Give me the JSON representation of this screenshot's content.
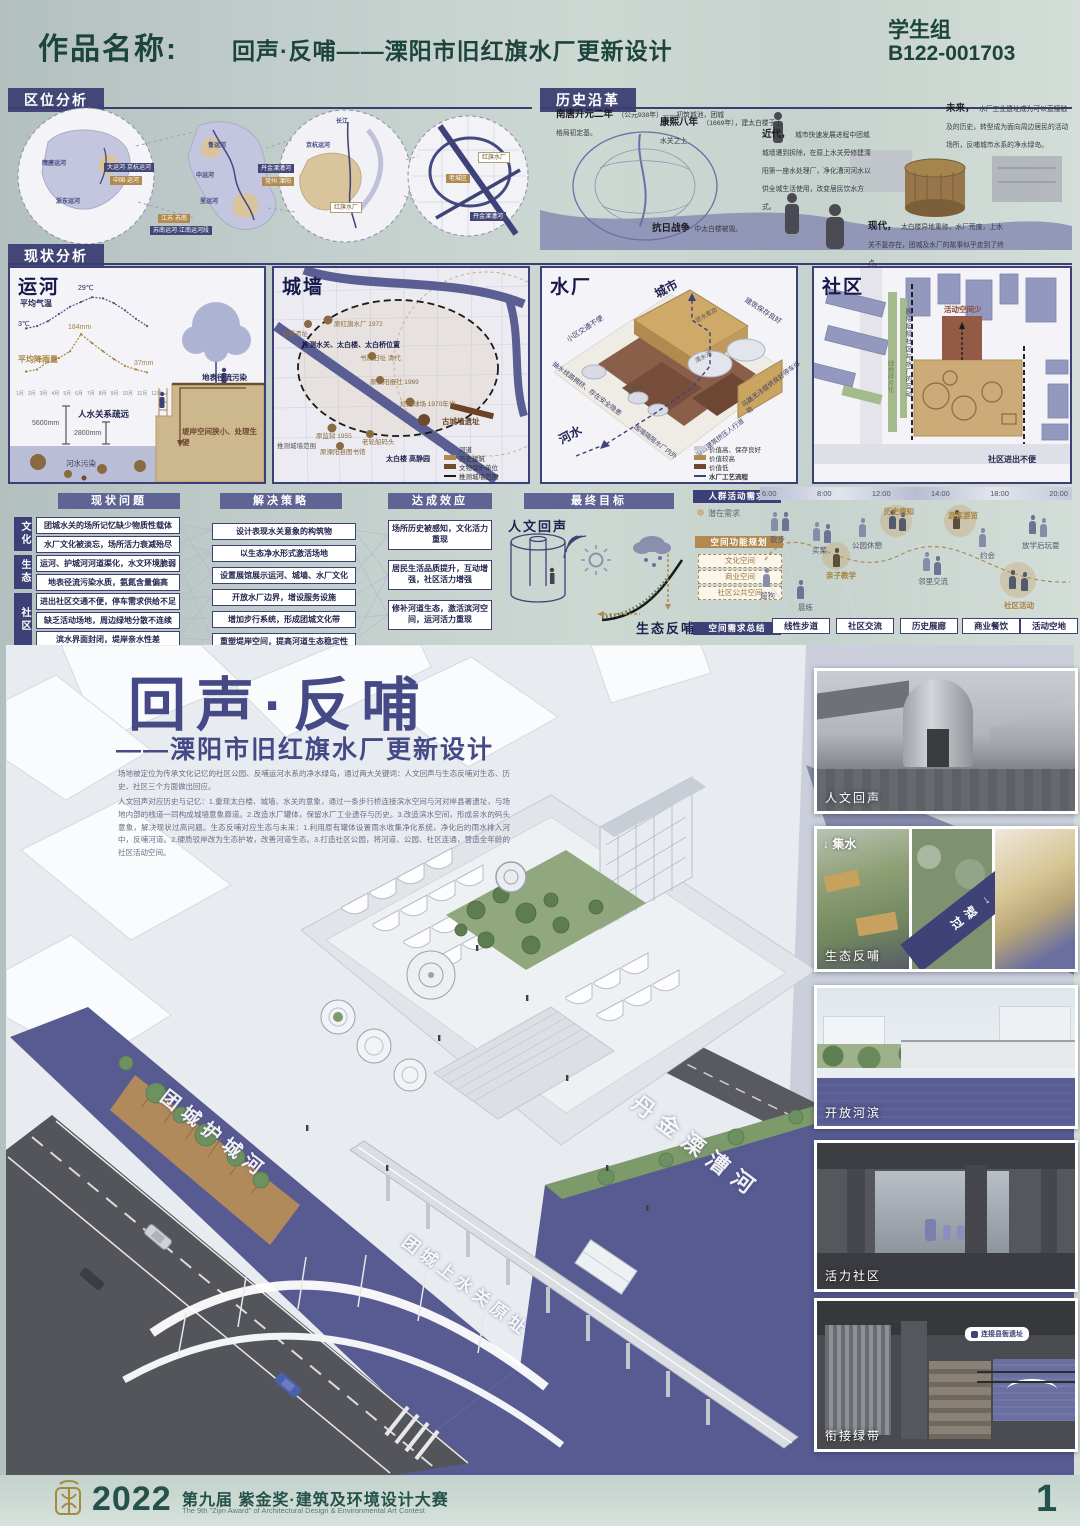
{
  "header": {
    "label": "作品名称:",
    "title": "回声·反哺——溧阳市旧红旗水厂更新设计",
    "group": "学生组",
    "code": "B122-001703"
  },
  "location": {
    "title": "区位分析",
    "map1": {
      "l1": "隋唐运河",
      "l2": "浙东运河",
      "badge_navy": "大运河·京杭运河",
      "badge_tan": "中国·运河"
    },
    "map2": {
      "l1": "鲁运河",
      "l2": "中运河",
      "l3": "里运河",
      "badge_tan": "江苏·苏南",
      "badge_navy": "苏南运河·江南运河段"
    },
    "map3": {
      "l1": "长江",
      "l2": "京杭运河",
      "badge_navy": "丹金溧漕河",
      "badge_tan": "常州·溧阳",
      "site": "红旗水厂"
    },
    "map4": {
      "site": "红旗水厂",
      "old": "老城区",
      "river": "丹金溧漕河"
    }
  },
  "history": {
    "title": "历史沿革",
    "events": [
      {
        "era": "南唐升元二年",
        "text": "（公元938年）——初筑城池，团城格局初定基。"
      },
      {
        "era": "康熙八年",
        "text": "（1669年），建太白楼于上水关之上"
      },
      {
        "era": "抗日战争",
        "text": "中太白楼被毁。"
      },
      {
        "era": "近代，",
        "text": "城市快速发展进程中团城城墙遭到拆除，在原上水关旁修建溧阳第一座水处理厂，净化漕河河水以供全城生活使用，改变居民饮水方式。"
      },
      {
        "era": "现代，",
        "text": "太白楼异地重修，水厂荒废，上水关不复存在，团城及水厂的故事似乎走到了终点。"
      },
      {
        "era": "未来，",
        "text": "水厂工业遗址成为可以直接触及的历史，转型成为面向周边居民的活动场所，反哺城市水系的净水绿岛。"
      }
    ]
  },
  "status": {
    "title": "现状分析",
    "canal": {
      "title": "运河",
      "temp_label": "平均气温",
      "temp_high": "29℃",
      "temp_low": "3℃",
      "rain_label": "平均降雨量",
      "rain_peak": "184mm",
      "rain_min": "37mm",
      "relation": "人水关系疏远",
      "depth1": "5600mm",
      "depth2": "2800mm",
      "water_note": "河水污染",
      "runoff_note": "地表径流污染",
      "bank_note": "堤岸空间狭小、处理生硬",
      "months": [
        "1月",
        "2月",
        "3月",
        "4月",
        "5月",
        "6月",
        "7月",
        "8月",
        "9月",
        "10月",
        "11月",
        "12月"
      ]
    },
    "wall": {
      "title": "城墙",
      "range": "推测城墙范围",
      "markers": [
        "县署遗址",
        "原红旗水厂 1972",
        "推测水关、太白楼、太白桥位置",
        "书院旧址 清代",
        "原溧阳报社 1969",
        "灯光球场 1970年代",
        "古城墙遗址",
        "原监狱 1955",
        "老轮船码头",
        "原溧阳县图书馆",
        "太白楼 高静园"
      ],
      "legend": [
        "河道",
        "历史建筑",
        "文物保护单位",
        "推测城墙范围"
      ]
    },
    "plant": {
      "title": "水厂",
      "city": "城市",
      "river": "河水",
      "notes": [
        "小区交通不便",
        "建筑保存良好",
        "抽水线路拥挤、存在安全隐患",
        "围墙隔阻水厂内外",
        "沿街建筑挤压人行道",
        "马路无法提供良好停车体验"
      ],
      "tanks": [
        "滤水池",
        "清水池",
        "送水泵房"
      ],
      "legend": [
        "价值高、保存良好",
        "价值较高",
        "价值低",
        "水厂工艺流程"
      ]
    },
    "community": {
      "title": "社区",
      "notes": [
        "活动空间少",
        "围墙阻隔社区与水厂的互动",
        "绿地碎片化",
        "社区进出不便"
      ]
    }
  },
  "strategy": {
    "problems": {
      "title": "现状问题",
      "categories": [
        "文化",
        "生态",
        "社区"
      ],
      "items": [
        "团城水关的场所记忆缺少物质性载体",
        "水厂文化被淡忘，场所活力衰减殆尽",
        "运河、护城河河道渠化，水文环境脆弱",
        "地表径流污染水质，氨氮含量偏高",
        "进出社区交通不便，停车需求供给不足",
        "缺乏活动场地，周边绿地分散不连续",
        "滨水界面封闭，堤岸亲水性差"
      ]
    },
    "solutions": {
      "title": "解决策略",
      "items": [
        "设计表现水关意象的构筑物",
        "以生态净水形式激活场地",
        "设置展馆展示运河、城墙、水厂文化",
        "开放水厂边界，增设服务设施",
        "增加步行系统，形成团城文化带",
        "重塑堤岸空间，提高河道生态稳定性"
      ]
    },
    "effects": {
      "title": "达成效应",
      "items": [
        "场所历史被感知，文化活力重现",
        "居民生活品质提升，互动增强，社区活力增强",
        "修补河道生态，激活滨河空间，运河活力重现"
      ]
    },
    "goal": {
      "title": "最终目标",
      "human": "人文回声",
      "eco": "生态反哺"
    },
    "demand": {
      "need_title": "人群活动需求",
      "need_legend": "潜在需求",
      "plan_title": "空间功能规划",
      "plan_items": [
        "文化空间",
        "商业空间",
        "社区公共空间"
      ],
      "summary_title": "空间需求总结",
      "summary_items": [
        "线性步道",
        "社区交流",
        "历史展廊",
        "商业餐饮",
        "活动空地"
      ],
      "hours": [
        "6:00",
        "8:00",
        "12:00",
        "14:00",
        "18:00",
        "20:00"
      ],
      "activities": [
        "散步",
        "遛狗",
        "晨练",
        "买菜",
        "亲子教学",
        "公园休憩",
        "历史感知",
        "游客游览",
        "邻里交流",
        "约会",
        "放学后玩耍",
        "社区活动"
      ]
    }
  },
  "main": {
    "title": "回声·反哺",
    "subtitle": "——溧阳市旧红旗水厂更新设计",
    "p1": "场地被定位为传承文化记忆的社区公园、反哺运河水系的净水绿岛，通过两大关键词：人文回声与生态反哺对生态、历史、社区三个方面做出回应。",
    "p2": "人文回声对应历史与记忆：1.重现太白楼、城墙、水关的意象，通过一条步行桥连接滨水空间与河对岸县署遗址，与场地内部的栈道一同构成城墙意象廊道。2.改造水厂罐体，保留水厂工业遗存与历史。3.改造滨水空间，形成亲水的码头意象，解决现状过高问题。生态反哺对应生态与未来：1.利用原有罐体设置雨水收集净化系统，净化后的雨水排入河中，反哺河道。2.硬质驳岸改为生态护坡，改善河道生态。3.打造社区公园，将河道、公园、社区连通，营造全年龄的社区活动空间。",
    "river_left": "团城护城河",
    "river_right": "丹金溧漕河",
    "gate": "团城上水关原址"
  },
  "gallery": {
    "c1": {
      "caption": "人文回声"
    },
    "c2": {
      "caption": "生态反哺",
      "label_collect": "集水",
      "label_filter": "过滤"
    },
    "c3": {
      "caption": "开放河滨"
    },
    "c4": {
      "caption": "活力社区"
    },
    "c5": {
      "caption": "衔接绿带",
      "bubble": "连接县衙遗址"
    }
  },
  "footer": {
    "year": "2022",
    "title": "第九届 紫金奖·建筑及环境设计大赛",
    "subtitle": "The 9th \"Zijin Award\" of Architectural Design & Environmental Art Contest",
    "page": "1"
  },
  "chart_data": {
    "type": "line",
    "title": "运河气候条件",
    "x": [
      "1月",
      "2月",
      "3月",
      "4月",
      "5月",
      "6月",
      "7月",
      "8月",
      "9月",
      "10月",
      "11月",
      "12月"
    ],
    "series": [
      {
        "name": "平均气温(℃)",
        "values": [
          3,
          5,
          9,
          15,
          21,
          25,
          29,
          28,
          24,
          18,
          11,
          5
        ]
      },
      {
        "name": "平均降雨量(mm)",
        "values": [
          40,
          48,
          78,
          92,
          118,
          184,
          150,
          118,
          88,
          62,
          48,
          37
        ]
      }
    ],
    "annotations": [
      "29℃",
      "3℃",
      "184mm",
      "37mm"
    ],
    "legend_position": "inline",
    "grid": false
  }
}
